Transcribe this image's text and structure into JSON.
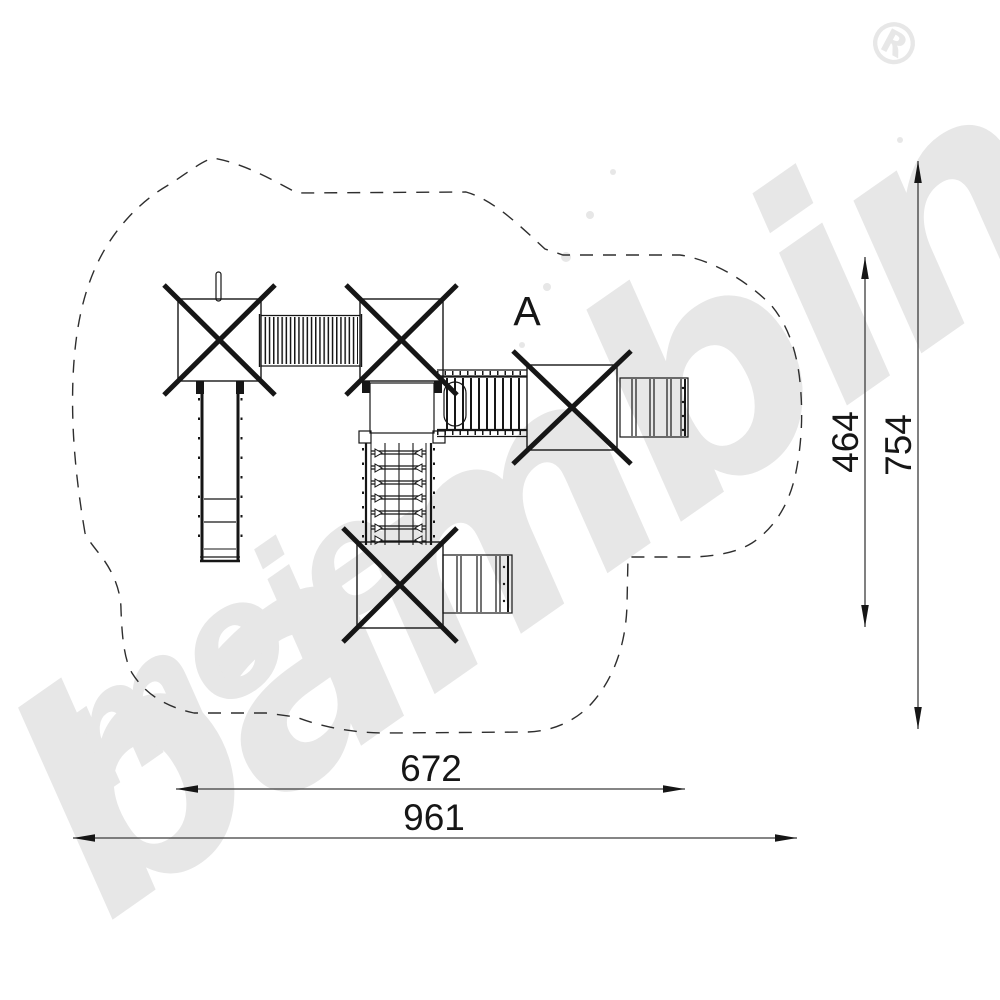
{
  "watermark": {
    "script_word_small": "moje",
    "script_word_large": "bambino",
    "registered_symbol": "®",
    "color": "#e7e7e7"
  },
  "drawing": {
    "section_label": "A"
  },
  "dimensions": {
    "bottom_inner": "672",
    "bottom_outer": "961",
    "right_inner": "464",
    "right_outer": "754"
  },
  "colors": {
    "line": "#161616",
    "dimension_line": "#3c3c3c",
    "boundary": "#2e2e2e",
    "watermark": "#e7e7e7",
    "background": "#ffffff"
  }
}
